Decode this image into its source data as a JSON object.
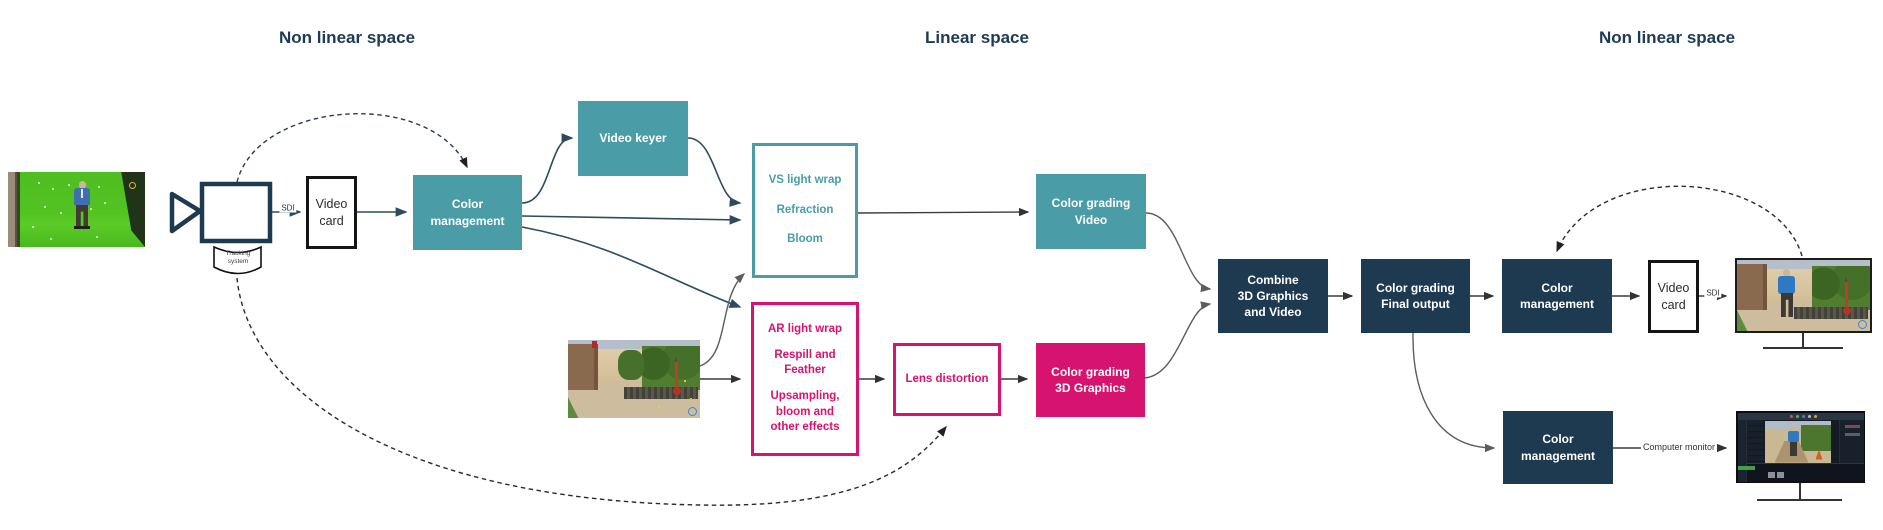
{
  "headers": {
    "left": "Non linear space",
    "center": "Linear space",
    "right": "Non linear space"
  },
  "nodes": {
    "tracking_system": {
      "label": "Tracking\nsystem"
    },
    "video_card_in": {
      "label": "Video\ncard"
    },
    "color_management_in": {
      "label": "Color\nmanagement"
    },
    "video_keyer": {
      "label": "Video keyer"
    },
    "vs_light_wrap": {
      "lines": [
        "VS light wrap",
        "Refraction",
        "Bloom"
      ]
    },
    "ar_light_wrap": {
      "lines": [
        "AR light wrap",
        "Respill and\nFeather",
        "Upsampling,\nbloom and\nother effects"
      ]
    },
    "lens_distortion": {
      "label": "Lens distortion"
    },
    "color_grading_video": {
      "label": "Color grading\nVideo"
    },
    "color_grading_3d": {
      "label": "Color grading\n3D Graphics"
    },
    "combine": {
      "label": "Combine\n3D Graphics\nand Video"
    },
    "color_grading_final": {
      "label": "Color grading\nFinal output"
    },
    "color_management_out": {
      "label": "Color\nmanagement"
    },
    "video_card_out": {
      "label": "Video\ncard"
    },
    "color_management_monitor": {
      "label": "Color\nmanagement"
    }
  },
  "labels": {
    "sdi_in": "SDI",
    "sdi_out": "SDI",
    "computer_monitor": "Computer monitor"
  },
  "colors": {
    "teal": "#4a9da6",
    "pink": "#d6146f",
    "navy": "#1d3a50",
    "header_text": "#1d3b55"
  }
}
